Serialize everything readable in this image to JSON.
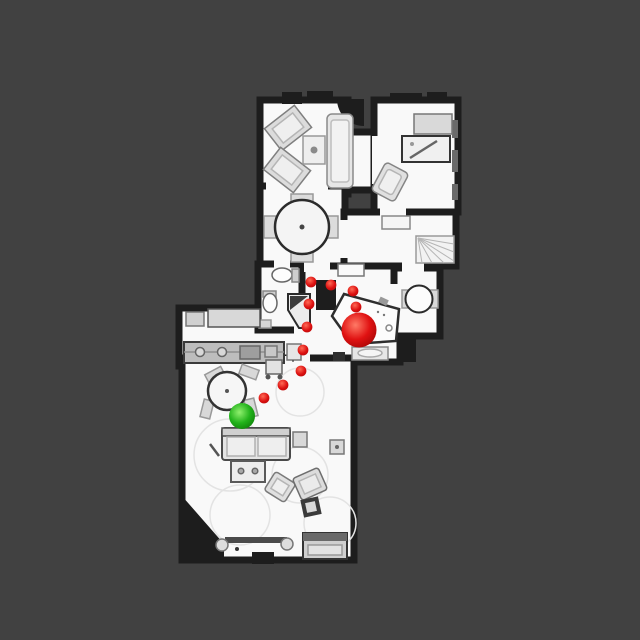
{
  "scene": {
    "background_color": "#414141",
    "floor_color": "#f9f9f9",
    "wall_color": "#1d1d1d",
    "furniture_fill": "#e2e2e2",
    "furniture_stroke": "#8a8a8a"
  },
  "navigation": {
    "start": {
      "label": "start-position",
      "x": 242,
      "y": 416,
      "radius": 13,
      "color": "#22b31b",
      "highlight": "#90f06e",
      "shadow": "#0d7d07"
    },
    "goal": {
      "label": "goal-position",
      "x": 359,
      "y": 330,
      "radius": 17.5,
      "color": "#e01212",
      "highlight": "#ff7a66",
      "shadow": "#a30505"
    },
    "waypoints": {
      "dot_radius": 5.4,
      "color": "#dc1010",
      "highlight": "#ff6a55",
      "shadow": "#b00909",
      "points": [
        {
          "x": 311,
          "y": 282
        },
        {
          "x": 331,
          "y": 285
        },
        {
          "x": 353,
          "y": 291
        },
        {
          "x": 309,
          "y": 304
        },
        {
          "x": 356,
          "y": 307
        },
        {
          "x": 307,
          "y": 327
        },
        {
          "x": 303,
          "y": 350
        },
        {
          "x": 301,
          "y": 371
        },
        {
          "x": 283,
          "y": 385
        },
        {
          "x": 264,
          "y": 398
        }
      ]
    }
  }
}
